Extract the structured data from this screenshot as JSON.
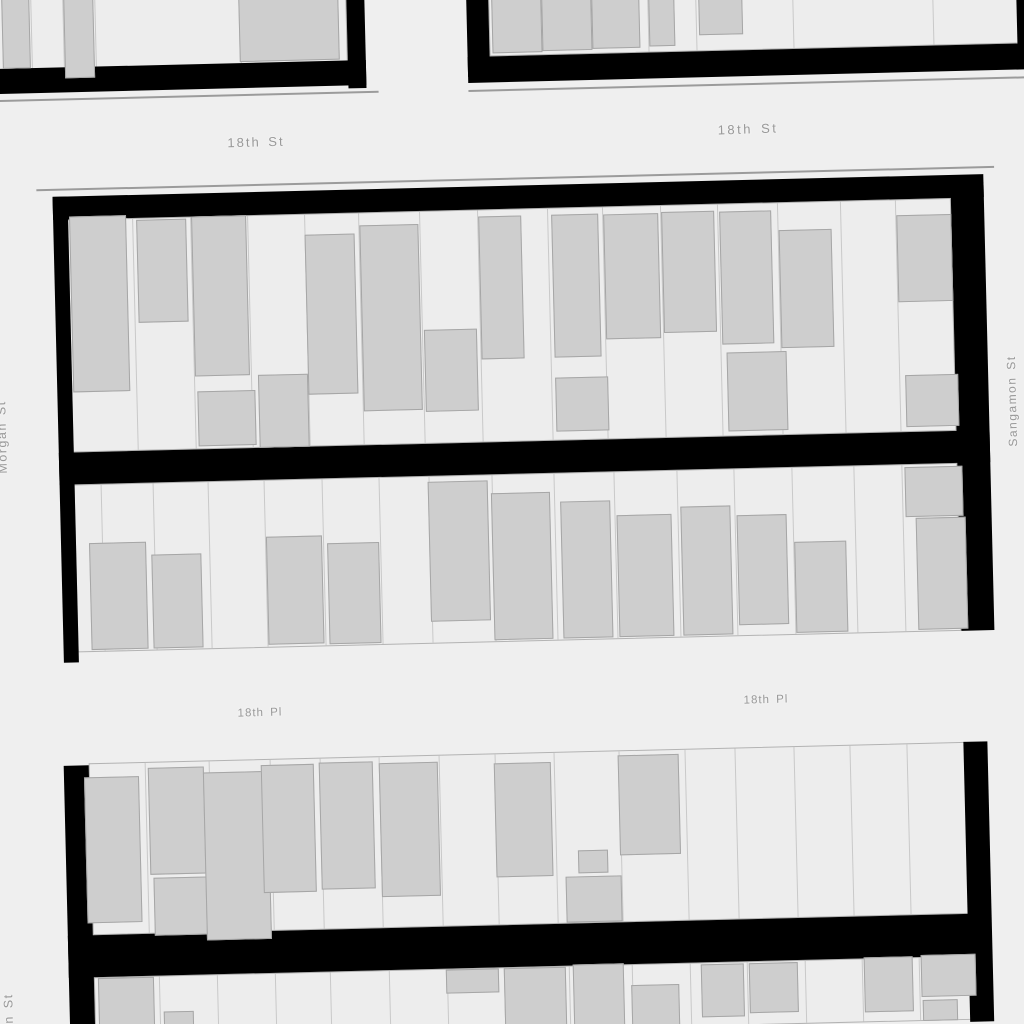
{
  "map": {
    "description": "Figure-ground parcel map of a city grid between 18th St and 18th Pl, Morgan St and Sangamon St",
    "colors": {
      "street_background": "#efefef",
      "parcel_fill": "#ededed",
      "parcel_border": "#b3b3b3",
      "parcel_divider": "#c9c9c9",
      "building_fill": "#cecece",
      "building_border": "#a6a6a6",
      "street_band": "#000000",
      "casing_line": "#9b9b9b",
      "label_color": "#999999",
      "label_halo": "#f2f2f2"
    },
    "street_labels": [
      {
        "text": "18th St",
        "x": 256,
        "y": 142,
        "rot": -1.5,
        "size": 13,
        "spacing": 2
      },
      {
        "text": "18th St",
        "x": 748,
        "y": 129,
        "rot": -2,
        "size": 13,
        "spacing": 2.5
      },
      {
        "text": "18th Pl",
        "x": 260,
        "y": 713,
        "rot": -1.5,
        "size": 11.5,
        "spacing": 1
      },
      {
        "text": "18th Pl",
        "x": 766,
        "y": 700,
        "rot": -1.5,
        "size": 11.5,
        "spacing": 1
      },
      {
        "text": "Morgan St",
        "x": 2,
        "y": 437,
        "rot": -91.4,
        "size": 12.5,
        "spacing": 1.5
      },
      {
        "text": "Morgan St",
        "x": 9,
        "y": 1030,
        "rot": -91.4,
        "size": 12.5,
        "spacing": 1.5
      },
      {
        "text": "Sangamon St",
        "x": 1012,
        "y": 401,
        "rot": -91.4,
        "size": 12,
        "spacing": 1.5
      }
    ],
    "blocks": [
      {
        "name": "block-northwest",
        "x": -45,
        "y": -50,
        "rot": -1.4,
        "parcel_areas": [
          {
            "x": 0,
            "y": 26,
            "w": 390,
            "h": 96,
            "dividers": [
              73,
              105,
              137,
              282
            ]
          }
        ],
        "bands": [
          {
            "x": 0,
            "y": 120,
            "w": 408,
            "h": 25
          },
          {
            "x": 390,
            "y": 0,
            "w": 18,
            "h": 148
          }
        ],
        "casings": [
          {
            "x": -20,
            "y": 151,
            "w": 440,
            "h": 2
          }
        ],
        "buildings": [
          {
            "x": 45,
            "y": 28,
            "w": 28,
            "h": 92
          },
          {
            "x": 107,
            "y": 28,
            "w": 30,
            "h": 103
          },
          {
            "x": 282,
            "y": 28,
            "w": 100,
            "h": 91
          }
        ]
      },
      {
        "name": "block-northeast",
        "x": 465,
        "y": -50,
        "rot": -1.4,
        "parcel_areas": [
          {
            "x": 22,
            "y": 0,
            "w": 556,
            "h": 107,
            "dividers": [
              180,
              228,
              325,
              465
            ]
          }
        ],
        "bands": [
          {
            "x": 0,
            "y": 0,
            "w": 22,
            "h": 127
          },
          {
            "x": 0,
            "y": 107,
            "w": 600,
            "h": 26
          },
          {
            "x": 550,
            "y": 0,
            "w": 30,
            "h": 108
          }
        ],
        "casings": [
          {
            "x": 0,
            "y": 140,
            "w": 620,
            "h": 2
          }
        ],
        "buildings": [
          {
            "x": 25,
            "y": 0,
            "w": 50,
            "h": 104
          },
          {
            "x": 75,
            "y": 0,
            "w": 50,
            "h": 103
          },
          {
            "x": 125,
            "y": 0,
            "w": 48,
            "h": 102
          },
          {
            "x": 182,
            "y": 0,
            "w": 26,
            "h": 101
          },
          {
            "x": 232,
            "y": 0,
            "w": 44,
            "h": 91
          }
        ]
      },
      {
        "name": "block-central",
        "x": 48,
        "y": 175,
        "rot": -1.4,
        "parcel_areas": [
          {
            "x": 18,
            "y": 45,
            "w": 884,
            "h": 233,
            "dividers": [
              82,
              140,
              197,
              254,
              308,
              369,
              427,
              497,
              552,
              610,
              667,
              727,
              790,
              845
            ]
          },
          {
            "x": 18,
            "y": 310,
            "w": 884,
            "h": 168,
            "dividers": [
              44,
              96,
              151,
              207,
              265,
              322,
              372,
              435,
              497,
              557,
              620,
              677,
              735,
              797,
              845
            ]
          }
        ],
        "bands": [
          {
            "x": 4,
            "y": 22,
            "w": 931,
            "h": 23
          },
          {
            "x": 4,
            "y": 22,
            "w": 15,
            "h": 466
          },
          {
            "x": 902,
            "y": 30,
            "w": 33,
            "h": 448
          },
          {
            "x": 4,
            "y": 278,
            "w": 931,
            "h": 32
          }
        ],
        "casings": [
          {
            "x": -12,
            "y": 14,
            "w": 958,
            "h": 2
          }
        ],
        "buildings": [
          {
            "x": 20,
            "y": 42,
            "w": 57,
            "h": 176
          },
          {
            "x": 87,
            "y": 47,
            "w": 50,
            "h": 103
          },
          {
            "x": 142,
            "y": 45,
            "w": 55,
            "h": 160
          },
          {
            "x": 144,
            "y": 220,
            "w": 58,
            "h": 55
          },
          {
            "x": 205,
            "y": 205,
            "w": 50,
            "h": 73
          },
          {
            "x": 255,
            "y": 66,
            "w": 50,
            "h": 160
          },
          {
            "x": 310,
            "y": 58,
            "w": 59,
            "h": 186
          },
          {
            "x": 372,
            "y": 164,
            "w": 53,
            "h": 82
          },
          {
            "x": 429,
            "y": 52,
            "w": 43,
            "h": 143
          },
          {
            "x": 502,
            "y": 52,
            "w": 47,
            "h": 143
          },
          {
            "x": 502,
            "y": 215,
            "w": 53,
            "h": 54
          },
          {
            "x": 554,
            "y": 53,
            "w": 55,
            "h": 125
          },
          {
            "x": 612,
            "y": 52,
            "w": 53,
            "h": 121
          },
          {
            "x": 670,
            "y": 53,
            "w": 52,
            "h": 133
          },
          {
            "x": 674,
            "y": 194,
            "w": 60,
            "h": 79
          },
          {
            "x": 729,
            "y": 73,
            "w": 53,
            "h": 118
          },
          {
            "x": 847,
            "y": 61,
            "w": 55,
            "h": 87
          },
          {
            "x": 852,
            "y": 221,
            "w": 53,
            "h": 52
          },
          {
            "x": 32,
            "y": 369,
            "w": 57,
            "h": 107
          },
          {
            "x": 94,
            "y": 382,
            "w": 50,
            "h": 94
          },
          {
            "x": 209,
            "y": 367,
            "w": 56,
            "h": 108
          },
          {
            "x": 270,
            "y": 375,
            "w": 52,
            "h": 101
          },
          {
            "x": 372,
            "y": 316,
            "w": 60,
            "h": 140
          },
          {
            "x": 435,
            "y": 329,
            "w": 59,
            "h": 147
          },
          {
            "x": 504,
            "y": 339,
            "w": 50,
            "h": 137
          },
          {
            "x": 560,
            "y": 354,
            "w": 55,
            "h": 122
          },
          {
            "x": 624,
            "y": 347,
            "w": 50,
            "h": 129
          },
          {
            "x": 680,
            "y": 357,
            "w": 50,
            "h": 110
          },
          {
            "x": 737,
            "y": 385,
            "w": 52,
            "h": 91
          },
          {
            "x": 849,
            "y": 313,
            "w": 58,
            "h": 50
          },
          {
            "x": 859,
            "y": 364,
            "w": 50,
            "h": 112
          }
        ]
      },
      {
        "name": "block-south",
        "x": 60,
        "y": 738,
        "rot": -1.4,
        "parcel_areas": [
          {
            "x": 28,
            "y": 26,
            "w": 877,
            "h": 172,
            "dividers": [
              83,
              147,
              208,
              258,
              317,
              377,
              433,
              492,
              557,
              623,
              673,
              732,
              788,
              845
            ]
          },
          {
            "x": 28,
            "y": 240,
            "w": 877,
            "h": 64,
            "dividers": [
              92,
              150,
              208,
              263,
              322,
              380,
              437,
              502,
              565,
              623,
              680,
              738,
              795,
              852
            ]
          }
        ],
        "bands": [
          {
            "x": 3,
            "y": 28,
            "w": 25,
            "h": 276
          },
          {
            "x": 903,
            "y": 26,
            "w": 24,
            "h": 280
          },
          {
            "x": 3,
            "y": 198,
            "w": 922,
            "h": 42
          }
        ],
        "casings": [],
        "buildings": [
          {
            "x": 23,
            "y": 40,
            "w": 55,
            "h": 146
          },
          {
            "x": 87,
            "y": 32,
            "w": 56,
            "h": 107
          },
          {
            "x": 90,
            "y": 142,
            "w": 53,
            "h": 58
          },
          {
            "x": 142,
            "y": 38,
            "w": 65,
            "h": 168
          },
          {
            "x": 200,
            "y": 32,
            "w": 53,
            "h": 128
          },
          {
            "x": 258,
            "y": 31,
            "w": 54,
            "h": 127
          },
          {
            "x": 318,
            "y": 33,
            "w": 59,
            "h": 134
          },
          {
            "x": 433,
            "y": 36,
            "w": 57,
            "h": 114
          },
          {
            "x": 515,
            "y": 125,
            "w": 30,
            "h": 23
          },
          {
            "x": 502,
            "y": 151,
            "w": 56,
            "h": 46
          },
          {
            "x": 557,
            "y": 31,
            "w": 61,
            "h": 100
          },
          {
            "x": 32,
            "y": 241,
            "w": 56,
            "h": 63
          },
          {
            "x": 97,
            "y": 276,
            "w": 30,
            "h": 28
          },
          {
            "x": 380,
            "y": 241,
            "w": 53,
            "h": 24
          },
          {
            "x": 438,
            "y": 241,
            "w": 62,
            "h": 63
          },
          {
            "x": 507,
            "y": 239,
            "w": 51,
            "h": 65
          },
          {
            "x": 565,
            "y": 261,
            "w": 48,
            "h": 43
          },
          {
            "x": 635,
            "y": 242,
            "w": 43,
            "h": 53
          },
          {
            "x": 683,
            "y": 242,
            "w": 49,
            "h": 50
          },
          {
            "x": 798,
            "y": 239,
            "w": 49,
            "h": 55
          },
          {
            "x": 855,
            "y": 238,
            "w": 55,
            "h": 42
          },
          {
            "x": 856,
            "y": 283,
            "w": 35,
            "h": 21
          }
        ]
      }
    ]
  }
}
